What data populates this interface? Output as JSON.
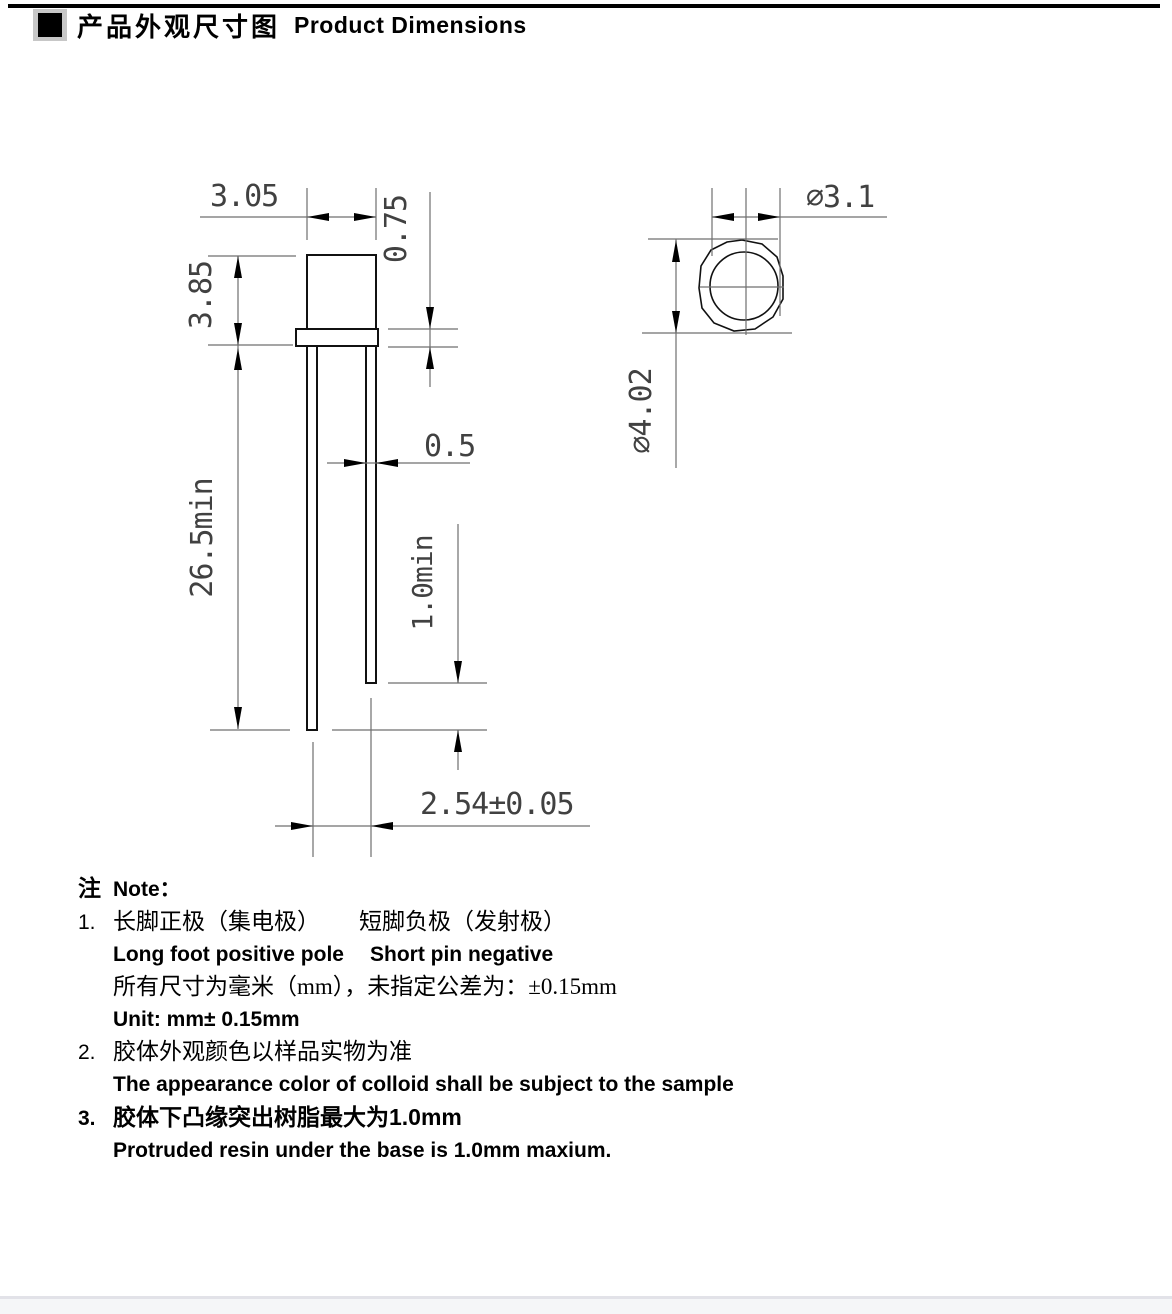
{
  "title": {
    "zh": "产品外观尺寸图",
    "en": "Product Dimensions"
  },
  "front_view": {
    "body_width": "3.05",
    "flange_thickness": "0.75",
    "body_height": "3.85",
    "lead_length_min": "26.5min",
    "lead_width": "0.5",
    "short_lead_min": "1.0min",
    "lead_pitch": "2.54±0.05"
  },
  "top_view": {
    "lens_diameter": "∅3.1",
    "flange_diameter": "∅4.02"
  },
  "notes": {
    "heading_zh": "注",
    "heading_en": "Note：",
    "item1_num": "1.",
    "item1_zh_a": "长脚正极（集电极）",
    "item1_zh_b": "短脚负极（发射极）",
    "item1_en_a": "Long foot positive pole",
    "item1_en_b": "Short pin negative",
    "item1_zh2": "所有尺寸为毫米（mm），未指定公差为：±0.15mm",
    "item1_en2": "Unit: mm± 0.15mm",
    "item2_num": "2.",
    "item2_zh": "胶体外观颜色以样品实物为准",
    "item2_en": "The appearance color of colloid shall be subject to the sample",
    "item3_num": "3.",
    "item3_zh": "胶体下凸缘突出树脂最大为1.0mm",
    "item3_en": "Protruded resin under the base is 1.0mm maxium."
  }
}
